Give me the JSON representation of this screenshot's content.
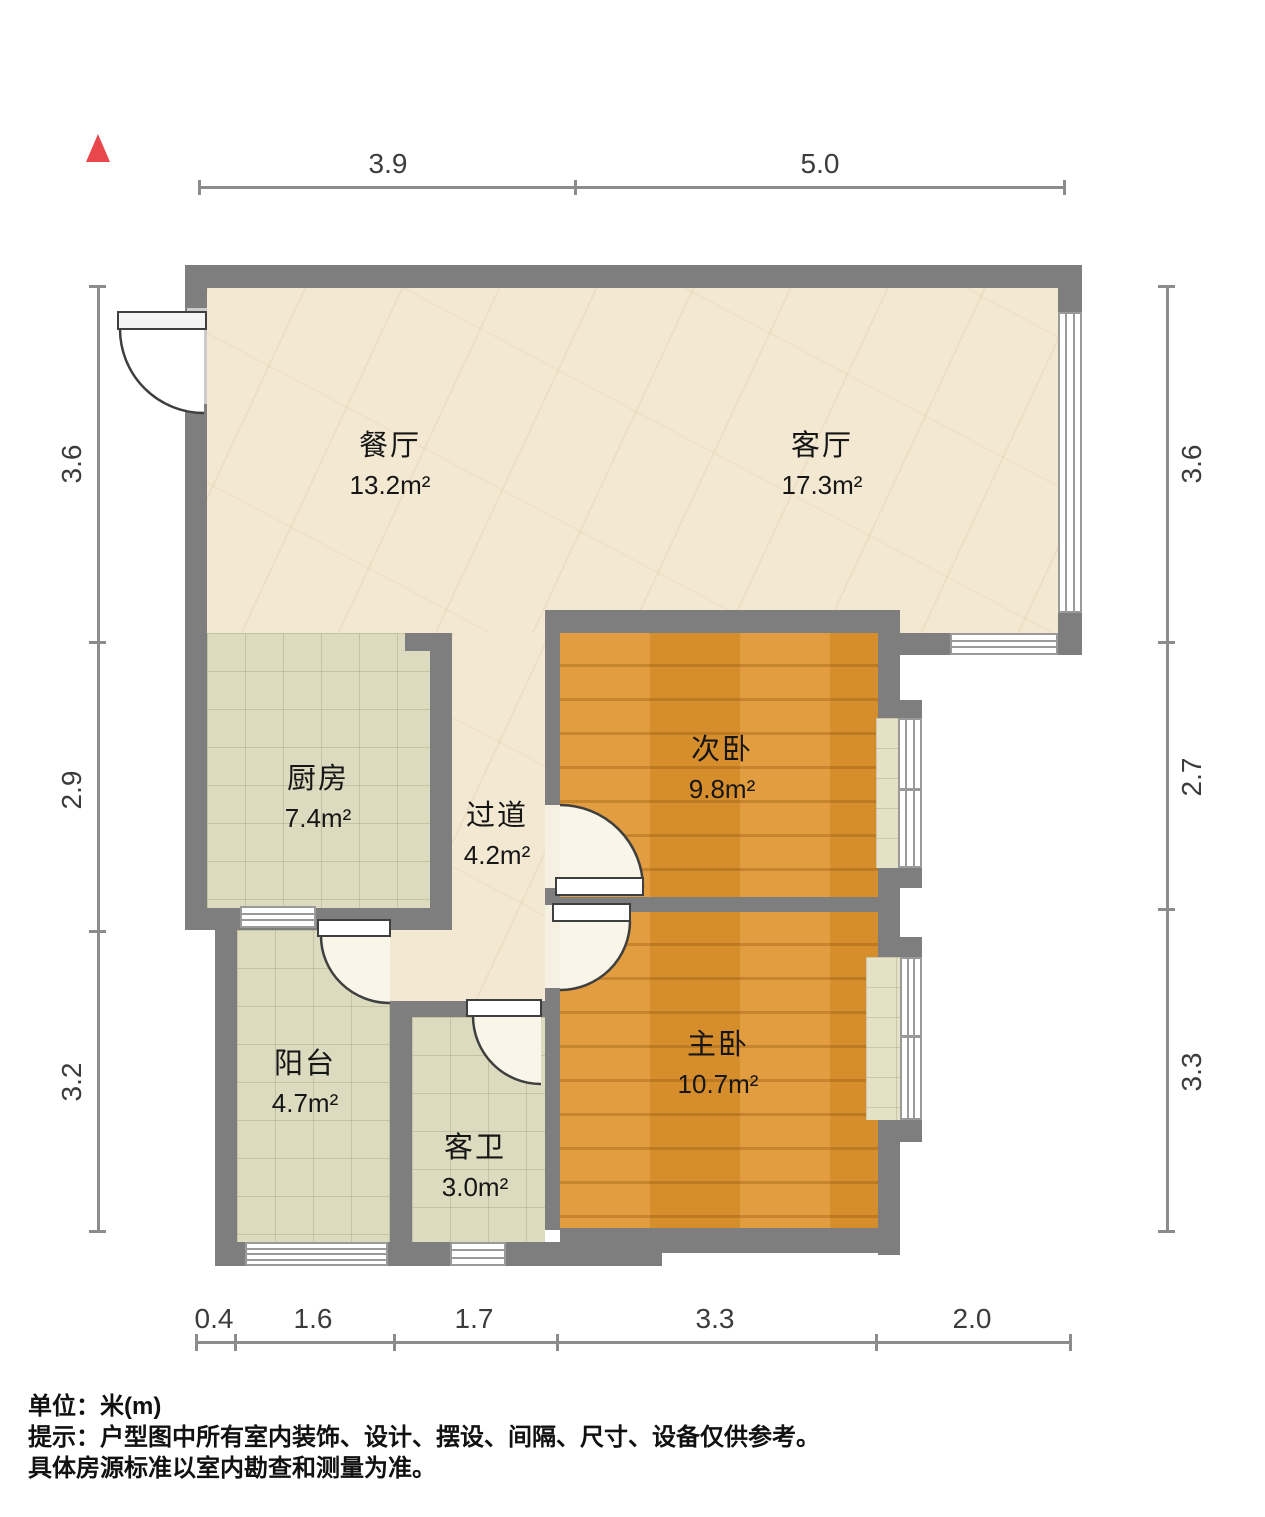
{
  "north_indicator": {
    "icon": "triangle-up",
    "color": "#e8474b"
  },
  "rooms": [
    {
      "id": "dining",
      "name": "餐厅",
      "area": "13.2m²"
    },
    {
      "id": "living",
      "name": "客厅",
      "area": "17.3m²"
    },
    {
      "id": "kitchen",
      "name": "厨房",
      "area": "7.4m²"
    },
    {
      "id": "hallway",
      "name": "过道",
      "area": "4.2m²"
    },
    {
      "id": "second-bedroom",
      "name": "次卧",
      "area": "9.8m²"
    },
    {
      "id": "master-bedroom",
      "name": "主卧",
      "area": "10.7m²"
    },
    {
      "id": "balcony",
      "name": "阳台",
      "area": "4.7m²"
    },
    {
      "id": "guest-bathroom",
      "name": "客卫",
      "area": "3.0m²"
    }
  ],
  "dimensions": {
    "top": [
      "3.9",
      "5.0"
    ],
    "right": [
      "3.6",
      "2.7",
      "3.3"
    ],
    "bottom": [
      "0.4",
      "1.6",
      "1.7",
      "3.3",
      "2.0"
    ],
    "left": [
      "3.6",
      "2.9",
      "3.2"
    ]
  },
  "footer": {
    "unit": "单位：米(m)",
    "hint1": "提示：户型图中所有室内装饰、设计、摆设、间隔、尺寸、设备仅供参考。",
    "hint2": "具体房源标准以室内勘查和测量为准。"
  },
  "colors": {
    "wall": "#7e7e7e",
    "marble_floor": "#f3e9d3",
    "tile_floor": "#dcdbc0",
    "wood_floor": "#e09631",
    "dimension_line": "#8c8c8c",
    "north_marker": "#e8474b"
  }
}
